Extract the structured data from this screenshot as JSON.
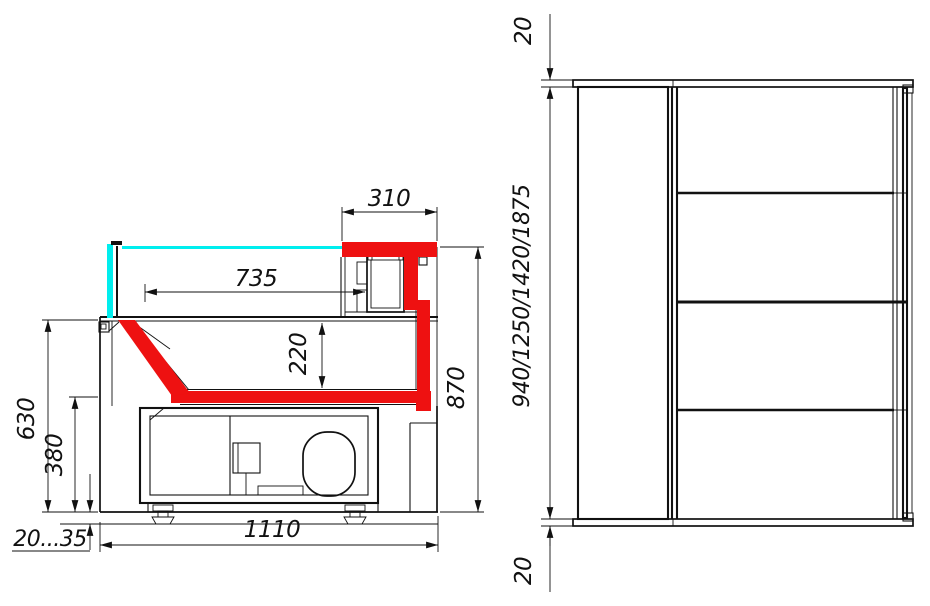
{
  "drawing": {
    "title": "counter-dimension-drawing",
    "colors": {
      "highlight_red": "#ee1111",
      "glass_cyan": "#00eeee",
      "line_black": "#111111",
      "background": "#ffffff"
    },
    "side_view": {
      "name": "side-section-view",
      "dims": {
        "top_unit_depth": "310",
        "display_surface_length": "735",
        "well_depth": "220",
        "overall_height": "870",
        "front_height": "630",
        "base_height": "380",
        "leg_adjustment": "20...35",
        "overall_depth": "1110"
      }
    },
    "plan_view": {
      "name": "plan-view",
      "dims": {
        "top_overhang": "20",
        "overall_lengths": "940/1250/1420/1875",
        "bottom_overhang": "20"
      }
    }
  }
}
